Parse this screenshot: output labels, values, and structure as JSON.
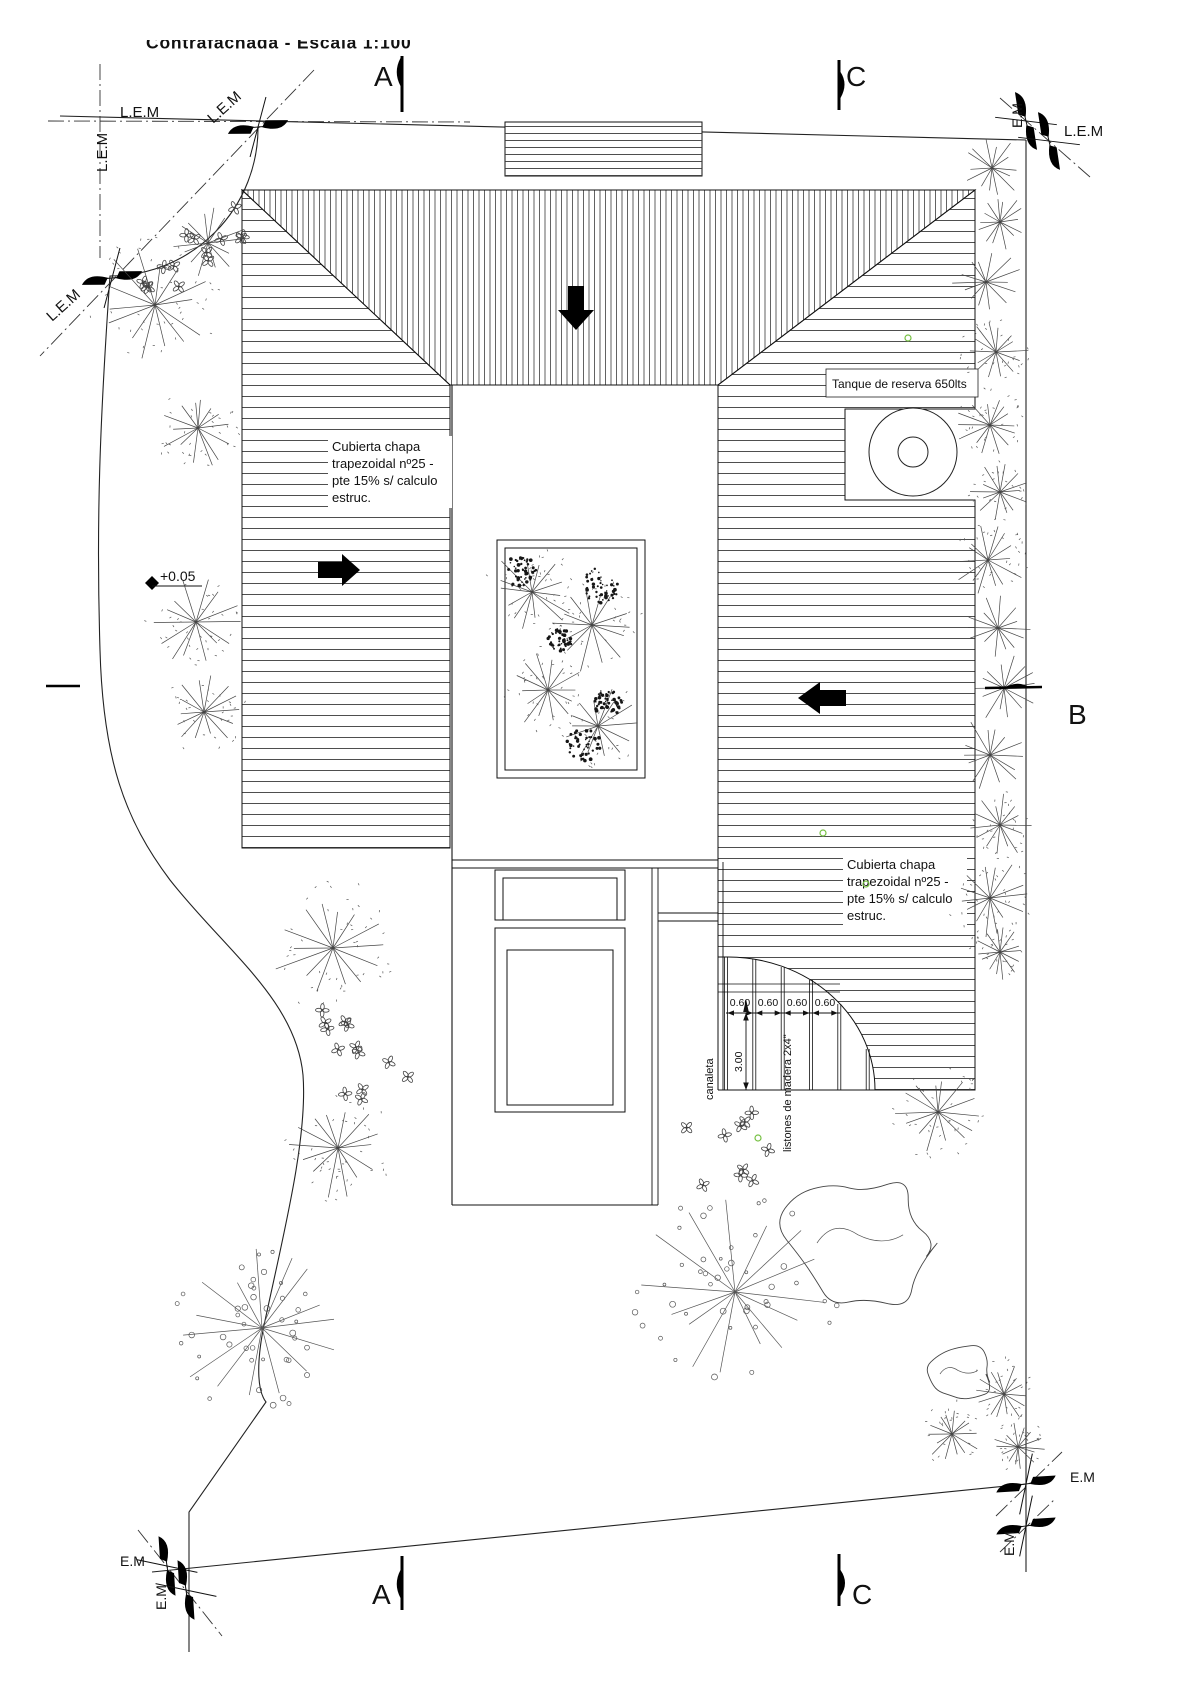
{
  "title": "Contrafachada - Escala 1:100",
  "sections": {
    "a": "A",
    "b": "B",
    "c": "C"
  },
  "boundary": {
    "lem": "L.E.M",
    "em": "E.M"
  },
  "notes": {
    "tank": "Tanque de reserva 650lts",
    "roof_note_lines": [
      "Cubierta chapa",
      "trapezoidal nº25 -",
      "pte 15% s/ calculo",
      "estruc."
    ]
  },
  "level": {
    "value": "+0.05"
  },
  "pergola": {
    "slat_widths": [
      "0.60",
      "0.60",
      "0.60",
      "0.60"
    ],
    "depth": "3.00",
    "channel_label": "canaleta",
    "slats_label": "listones de madera 2x4\""
  },
  "colors": {
    "ink": "#1a1a1a",
    "hatch": "#3a3a3a",
    "accent_green": "#76c043",
    "paper": "#ffffff"
  },
  "vegetation": [
    {
      "type": "speckle",
      "x": 155,
      "y": 305,
      "r": 62
    },
    {
      "type": "burst",
      "x": 208,
      "y": 243,
      "r": 38
    },
    {
      "type": "flowers",
      "x": 205,
      "y": 228,
      "r": 52,
      "n": 9
    },
    {
      "type": "flowers",
      "x": 150,
      "y": 292,
      "r": 34,
      "n": 5
    },
    {
      "type": "speckle",
      "x": 198,
      "y": 428,
      "r": 40
    },
    {
      "type": "speckle",
      "x": 196,
      "y": 622,
      "r": 46
    },
    {
      "type": "speckle",
      "x": 204,
      "y": 712,
      "r": 38
    },
    {
      "type": "speckle",
      "x": 333,
      "y": 948,
      "r": 62
    },
    {
      "type": "flowers",
      "x": 350,
      "y": 1032,
      "r": 28,
      "n": 5
    },
    {
      "type": "flowers",
      "x": 370,
      "y": 1078,
      "r": 40,
      "n": 8
    },
    {
      "type": "speckle",
      "x": 338,
      "y": 1148,
      "r": 52
    },
    {
      "type": "dotcircle",
      "x": 262,
      "y": 1328,
      "r": 92
    },
    {
      "type": "flowers",
      "x": 728,
      "y": 1148,
      "r": 48,
      "n": 10
    },
    {
      "type": "dotcircle",
      "x": 735,
      "y": 1292,
      "r": 98
    },
    {
      "type": "cloud",
      "x": 858,
      "y": 1243,
      "r": 82
    },
    {
      "type": "speckle",
      "x": 938,
      "y": 1112,
      "r": 44
    },
    {
      "type": "cloud",
      "x": 958,
      "y": 1374,
      "r": 36
    },
    {
      "type": "speckle",
      "x": 1004,
      "y": 1394,
      "r": 33
    },
    {
      "type": "speckle",
      "x": 952,
      "y": 1434,
      "r": 30
    },
    {
      "type": "speckle",
      "x": 1018,
      "y": 1447,
      "r": 27
    },
    {
      "type": "burst",
      "x": 992,
      "y": 168,
      "r": 32
    },
    {
      "type": "burst",
      "x": 1000,
      "y": 222,
      "r": 28
    },
    {
      "type": "burst",
      "x": 986,
      "y": 282,
      "r": 36
    },
    {
      "type": "speckle",
      "x": 996,
      "y": 352,
      "r": 34
    },
    {
      "type": "speckle",
      "x": 990,
      "y": 425,
      "r": 36
    },
    {
      "type": "speckle",
      "x": 1000,
      "y": 492,
      "r": 30
    },
    {
      "type": "speckle",
      "x": 988,
      "y": 560,
      "r": 38
    },
    {
      "type": "burst",
      "x": 998,
      "y": 628,
      "r": 33
    },
    {
      "type": "burst",
      "x": 1004,
      "y": 688,
      "r": 35
    },
    {
      "type": "burst",
      "x": 990,
      "y": 755,
      "r": 38
    },
    {
      "type": "speckle",
      "x": 1000,
      "y": 825,
      "r": 33
    },
    {
      "type": "speckle",
      "x": 990,
      "y": 898,
      "r": 40
    },
    {
      "type": "speckle",
      "x": 1000,
      "y": 952,
      "r": 28
    },
    {
      "type": "speckle",
      "x": 532,
      "y": 592,
      "r": 44
    },
    {
      "type": "speckle",
      "x": 592,
      "y": 625,
      "r": 48
    },
    {
      "type": "speckle",
      "x": 548,
      "y": 690,
      "r": 42
    },
    {
      "type": "speckle",
      "x": 598,
      "y": 726,
      "r": 40
    },
    {
      "type": "clump",
      "x": 520,
      "y": 572,
      "r": 16
    },
    {
      "type": "clump",
      "x": 601,
      "y": 585,
      "r": 18
    },
    {
      "type": "clump",
      "x": 608,
      "y": 703,
      "r": 14
    },
    {
      "type": "clump",
      "x": 584,
      "y": 744,
      "r": 17
    },
    {
      "type": "clump",
      "x": 560,
      "y": 640,
      "r": 12
    },
    {
      "type": "green",
      "x": 908,
      "y": 338,
      "r": 3
    },
    {
      "type": "green",
      "x": 823,
      "y": 833,
      "r": 3
    },
    {
      "type": "green",
      "x": 866,
      "y": 884,
      "r": 3
    },
    {
      "type": "green",
      "x": 758,
      "y": 1138,
      "r": 3
    }
  ]
}
